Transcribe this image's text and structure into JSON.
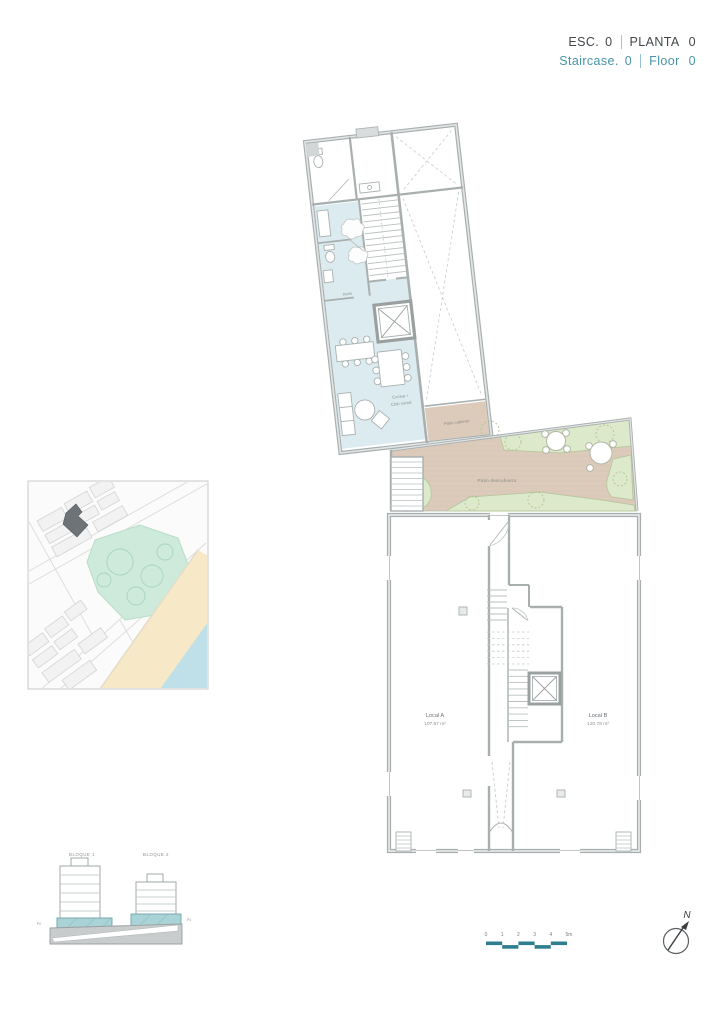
{
  "header": {
    "scale_label": "ESC.",
    "scale_value": "0",
    "floor_label": "PLANTA",
    "floor_value": "0",
    "scale_label_en": "Staircase.",
    "scale_value_en": "0",
    "floor_label_en": "Floor",
    "floor_value_en": "0"
  },
  "floor_plan": {
    "labels": {
      "aseo": "Aseo",
      "cocina_line1": "Cocina +",
      "cocina_line2": "Club social",
      "patio_cubierto": "Patio cubierto",
      "patio_descubierto": "Patio descubierto",
      "local_a_name": "Local A",
      "local_a_area": "107.87 m²",
      "local_b_name": "Local B",
      "local_b_area": "120.78 m²"
    }
  },
  "section_diagram": {
    "block1_label": "BLOQUE 1",
    "block2_label": "BLOQUE 2",
    "level_label_left": "P0",
    "level_label_right": "P0"
  },
  "scale_bar": {
    "ticks": [
      "0",
      "1",
      "2",
      "3",
      "4"
    ],
    "end_label": "5m"
  },
  "compass": {
    "north": "N"
  },
  "colors": {
    "accent_teal": "#4796A6",
    "scalebar_teal": "#2F7E90",
    "slab_teal": "#A9D3D6",
    "room_blue": "#DCEBEF",
    "patio_tan": "#DCCABA",
    "patio_green": "#DDE9CB",
    "map_green": "#CDEADA",
    "map_sand": "#F7E9C8",
    "map_water": "#BFE0E8",
    "wall_gray": "#A9AFAF",
    "text_dark": "#41474A",
    "text_gray": "#8B9194",
    "site_marker": "#6E7377"
  }
}
